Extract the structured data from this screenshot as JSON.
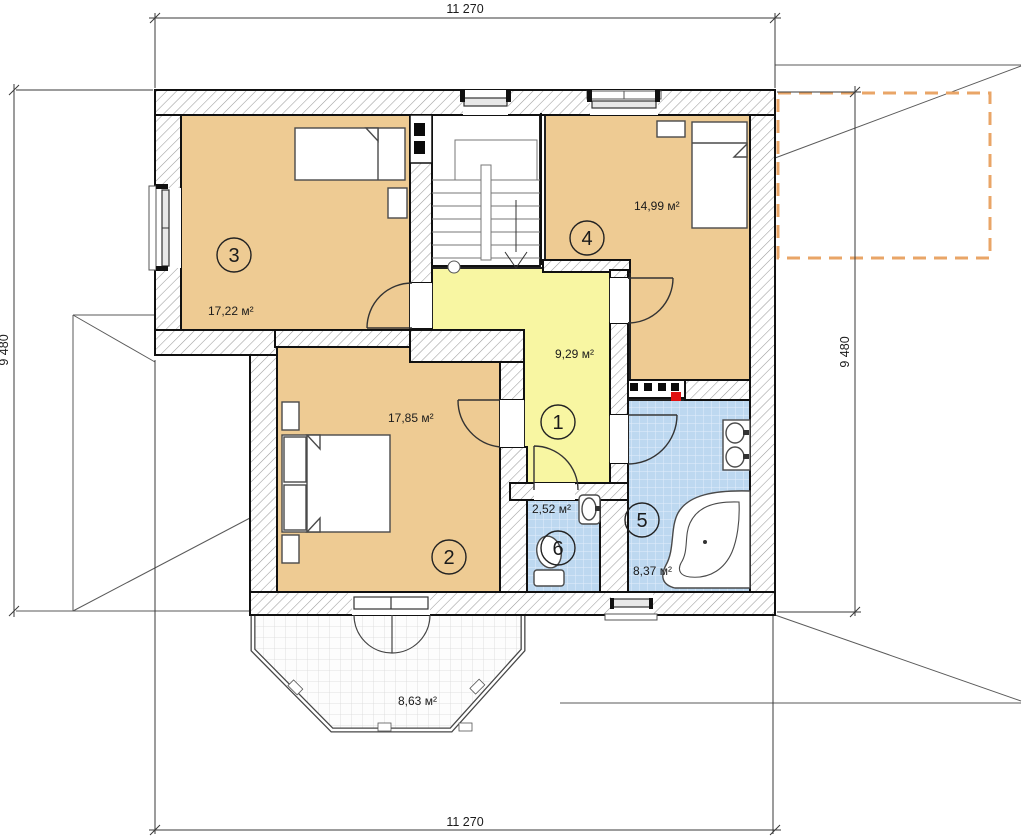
{
  "plan": {
    "dimensions": {
      "top": "11 270",
      "bottom": "11 270",
      "left": "9 480",
      "right": "9 480"
    },
    "rooms": {
      "hall": {
        "number": "1",
        "area": "9,29 м²"
      },
      "bedroom2": {
        "number": "2",
        "area": "17,85 м²"
      },
      "bedroom3": {
        "number": "3",
        "area": "17,22 м²"
      },
      "bedroom4": {
        "number": "4",
        "area": "14,99 м²"
      },
      "bathroom": {
        "number": "5",
        "area": "8,37 м²"
      },
      "wc": {
        "number": "6",
        "area": "2,52 м²"
      },
      "balcony": {
        "area": "8,63 м²"
      }
    },
    "colors": {
      "bedroom_fill": "#eecb93",
      "hall_fill": "#f8f6a2",
      "tile_fill": "#bdd8f0",
      "vent_red": "#e01010",
      "dashed_orange": "#e9a567"
    }
  }
}
